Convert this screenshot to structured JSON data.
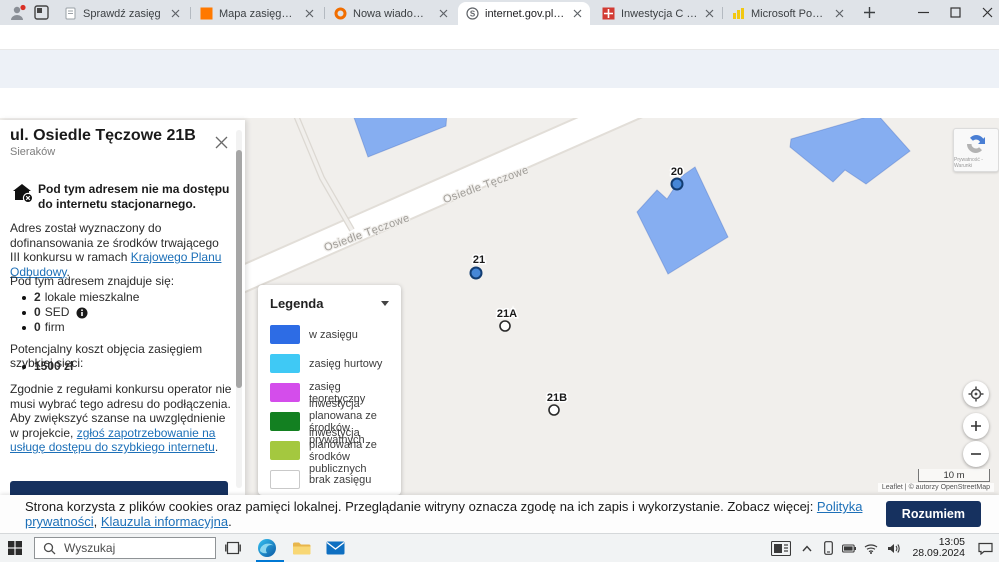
{
  "browser": {
    "tabs": [
      {
        "label": "Sprawdź zasięg"
      },
      {
        "label": "Mapa zasięgu Orange | Ora"
      },
      {
        "label": "Nowa wiadomość - Nasz O"
      },
      {
        "label": "internet.gov.pl - Mapa",
        "icon_char": "S"
      },
      {
        "label": "Inwestycja C 1.1.1 Zapewni"
      },
      {
        "label": "Microsoft Power BI"
      }
    ],
    "url_scheme": "https://",
    "url_host": "internet.gov.pl",
    "url_path": "/map/?center=1788106.7798756089%3B6917668.8881888648&zoom=20"
  },
  "site": {
    "logo": "internet.gov.pl",
    "nav": [
      {
        "label": "Mapa"
      },
      {
        "label": "Statystyki"
      },
      {
        "label": "Masz pytania?"
      }
    ],
    "user": "WIKTOR",
    "actions": [
      {
        "label": "Twoje adresy"
      },
      {
        "label": "Zgłoszenia"
      }
    ]
  },
  "panel": {
    "title": "ul. Osiedle Tęczowe 21B",
    "subtitle": "Sieraków",
    "no_access": "Pod tym adresem nie ma dostępu do internetu stacjonarnego.",
    "funding": {
      "pre": "Adres został wyznaczony do dofinansowania ze środków trwającego III konkursu w ramach ",
      "link": "Krajowego Planu Odbudowy",
      "post": "."
    },
    "contains_label": "Pod tym adresem znajduje się:",
    "items": [
      {
        "value": "2",
        "label": "lokale mieszkalne"
      },
      {
        "value": "0",
        "label": "SED"
      },
      {
        "value": "0",
        "label": "firm"
      }
    ],
    "cost_label": "Potencjalny koszt objęcia zasięgiem szybkiej sieci:",
    "cost_value": "1500 zł",
    "rules": {
      "pre": "Zgodnie z regułami konkursu operator nie musi wybrać tego adresu do podłączenia. Aby zwiększyć szanse na uwzględnienie w projekcie, ",
      "link": "zgłoś zapotrzebowanie na usługę dostępu do szybkiego internetu",
      "post": "."
    }
  },
  "legend": {
    "title": "Legenda",
    "items": [
      {
        "color": "#2d6ce5",
        "label": "w zasięgu"
      },
      {
        "color": "#3fc9f5",
        "label": "zasięg hurtowy"
      },
      {
        "color": "#d44deb",
        "label": "zasięg teoretyczny"
      },
      {
        "color": "#138021",
        "label": "inwestycja planowana ze środków prywatnych"
      },
      {
        "color": "#a4c83f",
        "label": "inwestycja planowana ze środków publicznych"
      },
      {
        "color": "#ffffff",
        "label": "brak zasięgu"
      }
    ]
  },
  "map": {
    "street_label": "Osiedle Tęczowe",
    "building_color": "#86aef1",
    "marker_fill": "#4687d7",
    "markers": [
      {
        "label": "20"
      },
      {
        "label": "21"
      },
      {
        "label": "21A"
      },
      {
        "label": "21B"
      }
    ],
    "scale": "10 m",
    "attribution": "Leaflet | © autorzy OpenStreetMap",
    "recaptcha_text": "Prywatność - Warunki"
  },
  "cookie": {
    "pre": "Strona korzysta z plików cookies oraz pamięci lokalnej. Przeglądanie witryny oznacza zgodę na ich zapis i wykorzystanie. Zobacz więcej: ",
    "link1": "Polityka prywatności",
    "sep": ", ",
    "link2": "Klauzula informacyjna",
    "post": ".",
    "button": "Rozumiem"
  },
  "taskbar": {
    "search_placeholder": "Wyszukaj",
    "time": "13:05",
    "date": "28.09.2024"
  }
}
